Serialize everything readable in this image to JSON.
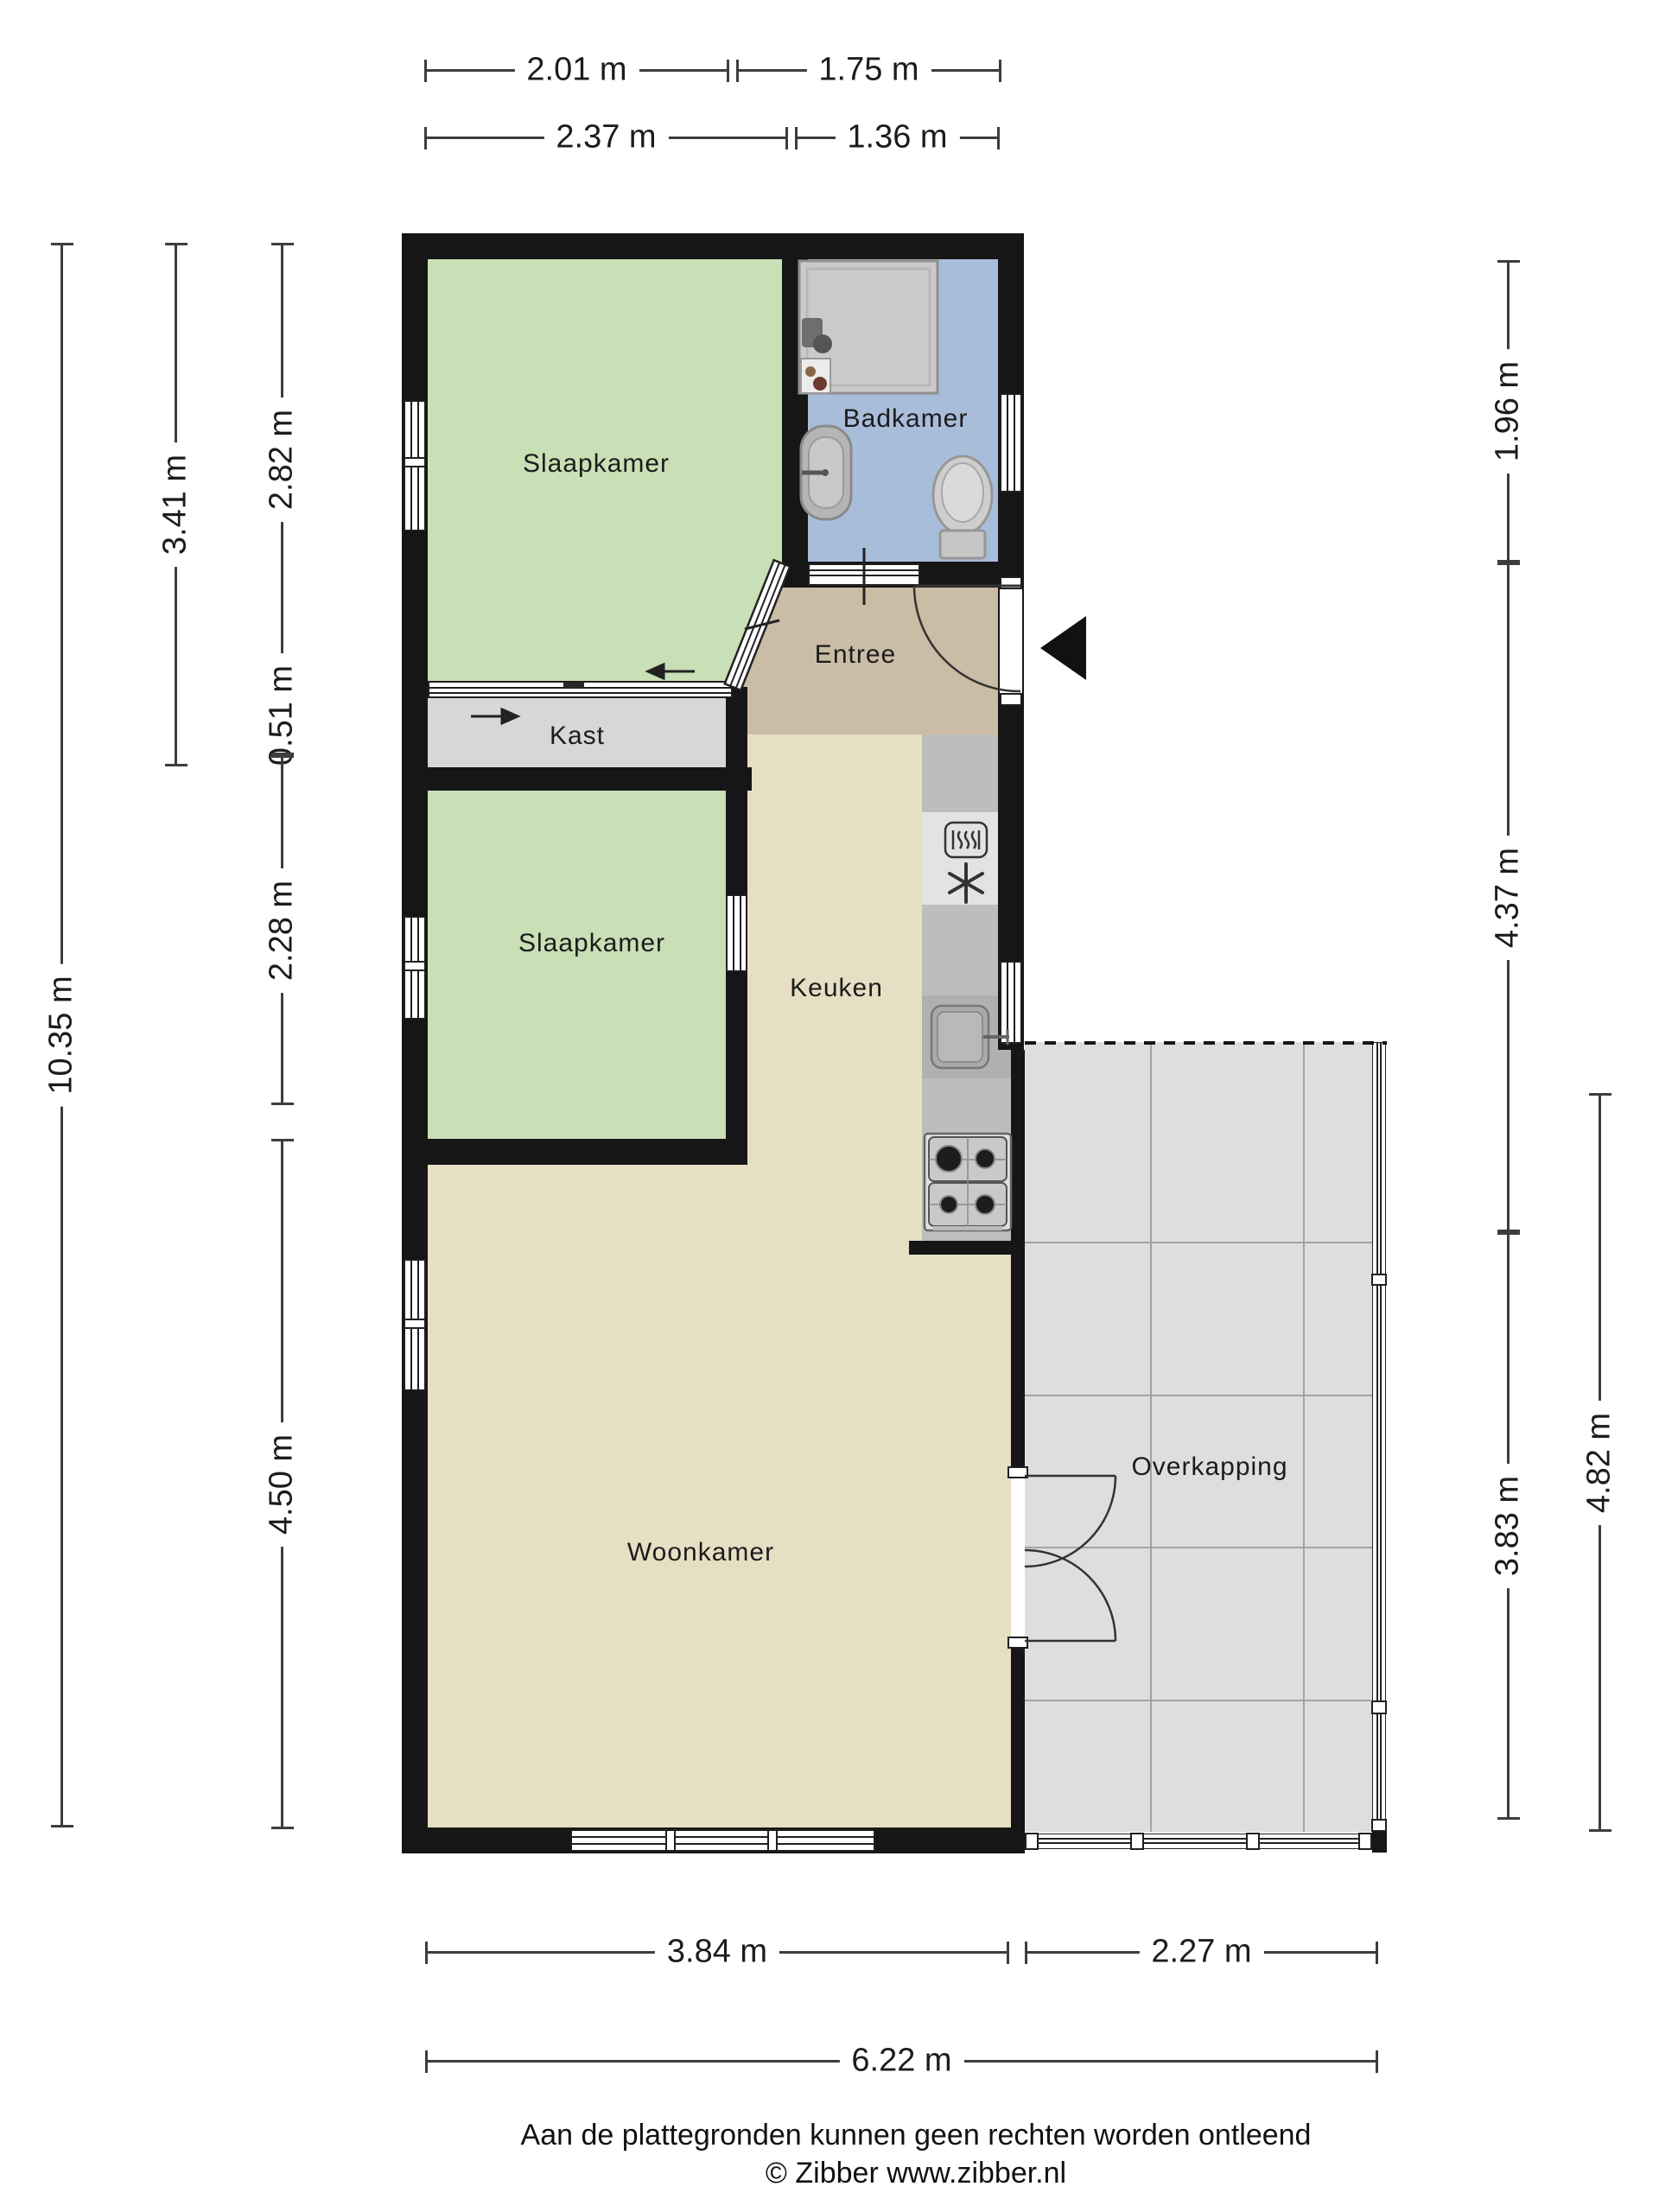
{
  "footer": {
    "disclaimer": "Aan de plattegronden kunnen geen rechten worden ontleend",
    "copyright": "© Zibber www.zibber.nl"
  },
  "rooms": {
    "slaapkamer_1": {
      "label": "Slaapkamer"
    },
    "badkamer": {
      "label": "Badkamer"
    },
    "entree": {
      "label": "Entree"
    },
    "kast": {
      "label": "Kast"
    },
    "slaapkamer_2": {
      "label": "Slaapkamer"
    },
    "keuken": {
      "label": "Keuken"
    },
    "woonkamer": {
      "label": "Woonkamer"
    },
    "overkapping": {
      "label": "Overkapping"
    }
  },
  "dimensions": {
    "top_row1": [
      {
        "label": "2.01 m"
      },
      {
        "label": "1.75 m"
      }
    ],
    "top_row2": [
      {
        "label": "2.37 m"
      },
      {
        "label": "1.36 m"
      }
    ],
    "left": [
      {
        "label": "10.35 m"
      },
      {
        "label": "3.41 m"
      },
      {
        "label": "2.82 m"
      },
      {
        "label": "0.51 m"
      },
      {
        "label": "2.28 m"
      },
      {
        "label": "4.50 m"
      }
    ],
    "right": [
      {
        "label": "1.96 m"
      },
      {
        "label": "4.37 m"
      },
      {
        "label": "3.83 m"
      },
      {
        "label": "4.82 m"
      }
    ],
    "bottom_row1": [
      {
        "label": "3.84 m"
      },
      {
        "label": "2.27 m"
      }
    ],
    "bottom_row2": [
      {
        "label": "6.22 m"
      }
    ]
  },
  "colors": {
    "wall": "#161616",
    "bedroom_green": "#c9dfb5",
    "bathroom_blue": "#a8bdda",
    "entry_tan": "#cbbca5",
    "living_cream": "#e7dfc3",
    "closet_gray": "#d7d7d7",
    "canopy_gray": "#dedede",
    "counter_gray": "#bdbdbd"
  },
  "icons": {
    "entrance_marker": "entrance-arrow-icon",
    "bathroom": [
      "shower-icon",
      "washbasin-icon",
      "toilet-icon"
    ],
    "kitchen": [
      "microwave-icon",
      "freezer-snowflake-icon",
      "kitchen-sink-icon",
      "stove-icon"
    ],
    "doors": [
      "door-swing-icon",
      "sliding-door-icon",
      "double-door-icon"
    ]
  }
}
